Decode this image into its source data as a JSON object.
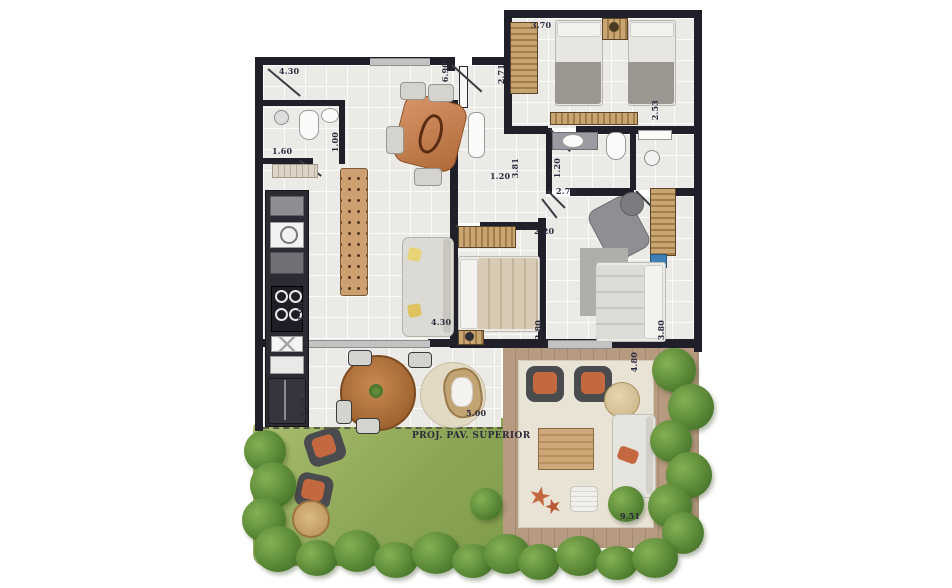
{
  "plan_title": "apartment-garden-floor-plan",
  "note": {
    "upper_floor_projection": "PROJ. PAV. SUPERIOR"
  },
  "dims": {
    "living_top_width": "4.30",
    "living_length": "6.90",
    "bedroom_top_width": "3.70",
    "hall_depth": "2.71",
    "bedroom_top_depth": "2.53",
    "bathroom_width": "1.60",
    "bathroom_depth": "1.00",
    "corridor_width": "1.20",
    "corridor_length": "3.81",
    "suite_bath_width": "1.20",
    "suite_width": "2.70",
    "bedroom_mid_width": "2.20",
    "kitchen_length": "3.90",
    "living_width": "4.30",
    "bedroom_mid_length": "2.80",
    "suite_length": "3.80",
    "service_length": "2.10",
    "terrace_width": "5.00",
    "deck_depth": "4.80",
    "deck_width": "9.51"
  },
  "colors": {
    "wall": "#20202b",
    "grass": "#8fae52",
    "deck_wood": "#b79b80",
    "furniture_wood": "#c07a4a",
    "accent_orange": "#c4683f",
    "label_text": "#2b2b3e"
  }
}
